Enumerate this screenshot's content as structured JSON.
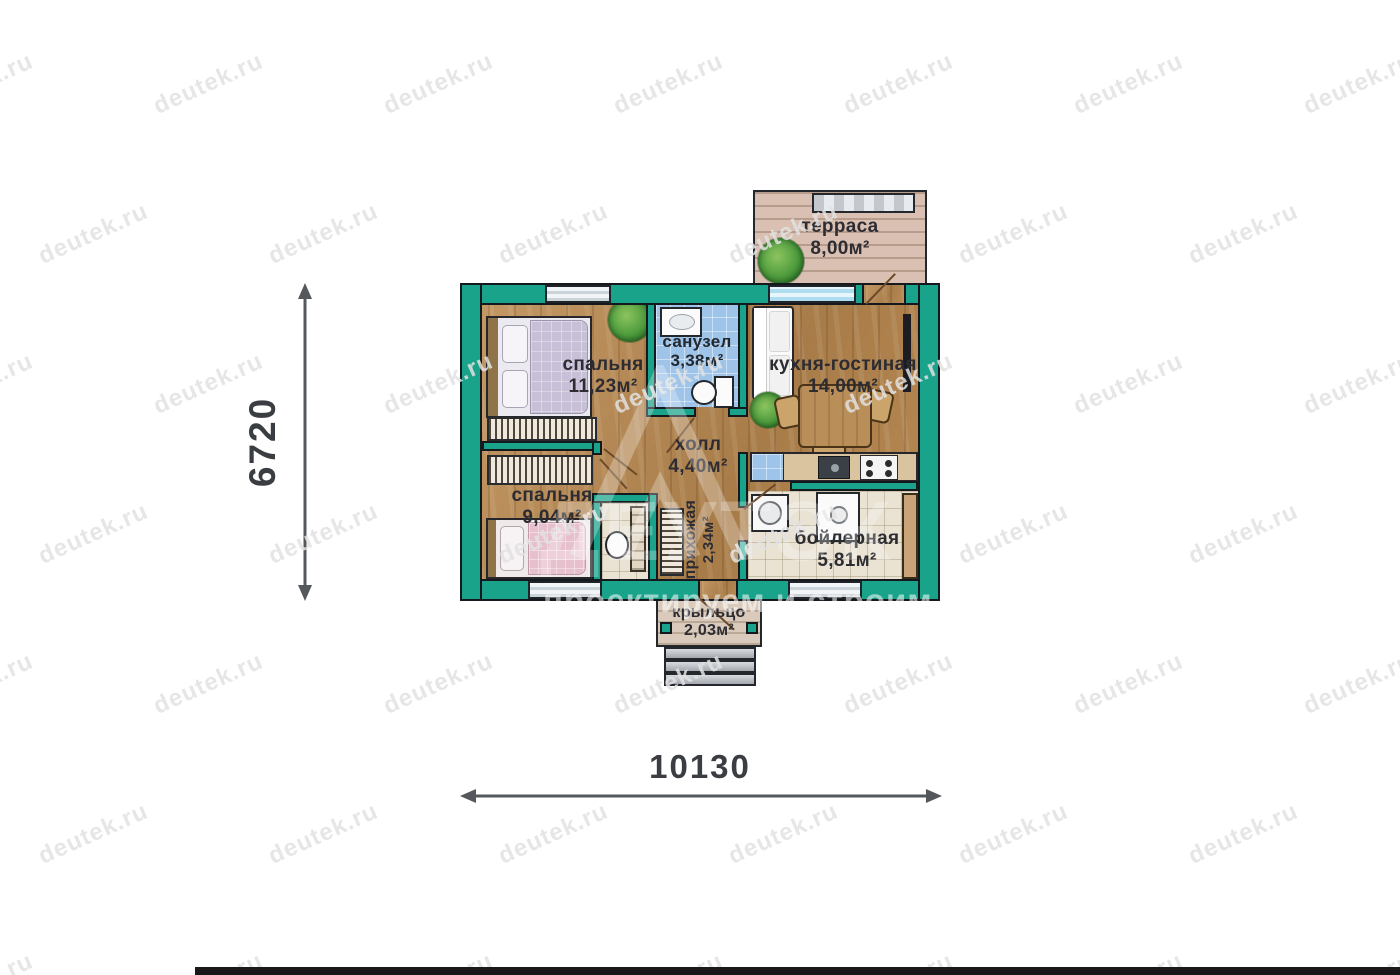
{
  "watermark": {
    "text": "deutek.ru",
    "x_start": -80,
    "y_start": 70,
    "x_step": 230,
    "y_step": 150,
    "row_offset": 115,
    "rows": 7,
    "cols": 8,
    "angle_deg": -24
  },
  "brand": {
    "name": "ДЕУТЭК",
    "slogan": "проектируем и строим"
  },
  "dimensions": {
    "height_label": "6720",
    "width_label": "10130"
  },
  "rooms": [
    {
      "id": "terrace",
      "name": "терраса",
      "area": "8,00м²"
    },
    {
      "id": "bedroom1",
      "name": "спальня",
      "area": "11,23м²"
    },
    {
      "id": "bathroom",
      "name": "санузел",
      "area": "3,38м²"
    },
    {
      "id": "kitchen",
      "name": "кухня-гостиная",
      "area": "14,00м²"
    },
    {
      "id": "hall",
      "name": "холл",
      "area": "4,40м²"
    },
    {
      "id": "bedroom2",
      "name": "спальня",
      "area": "9,04м²"
    },
    {
      "id": "entry",
      "name": "прихожая",
      "area": "2,34м²"
    },
    {
      "id": "boiler",
      "name": "бойлерная",
      "area": "5,81м²"
    },
    {
      "id": "porch",
      "name": "крыльцо",
      "area": "2,03м²"
    }
  ],
  "colors": {
    "wall_teal": "#18a38a",
    "wood": "#b98a54",
    "deck": "#d9c0b2",
    "tile_blue": "#9fc4ea",
    "tile_beige": "#eae3d4",
    "label": "#2c2c32",
    "dim": "#3a3d42",
    "bottom_bar": "#191919"
  }
}
